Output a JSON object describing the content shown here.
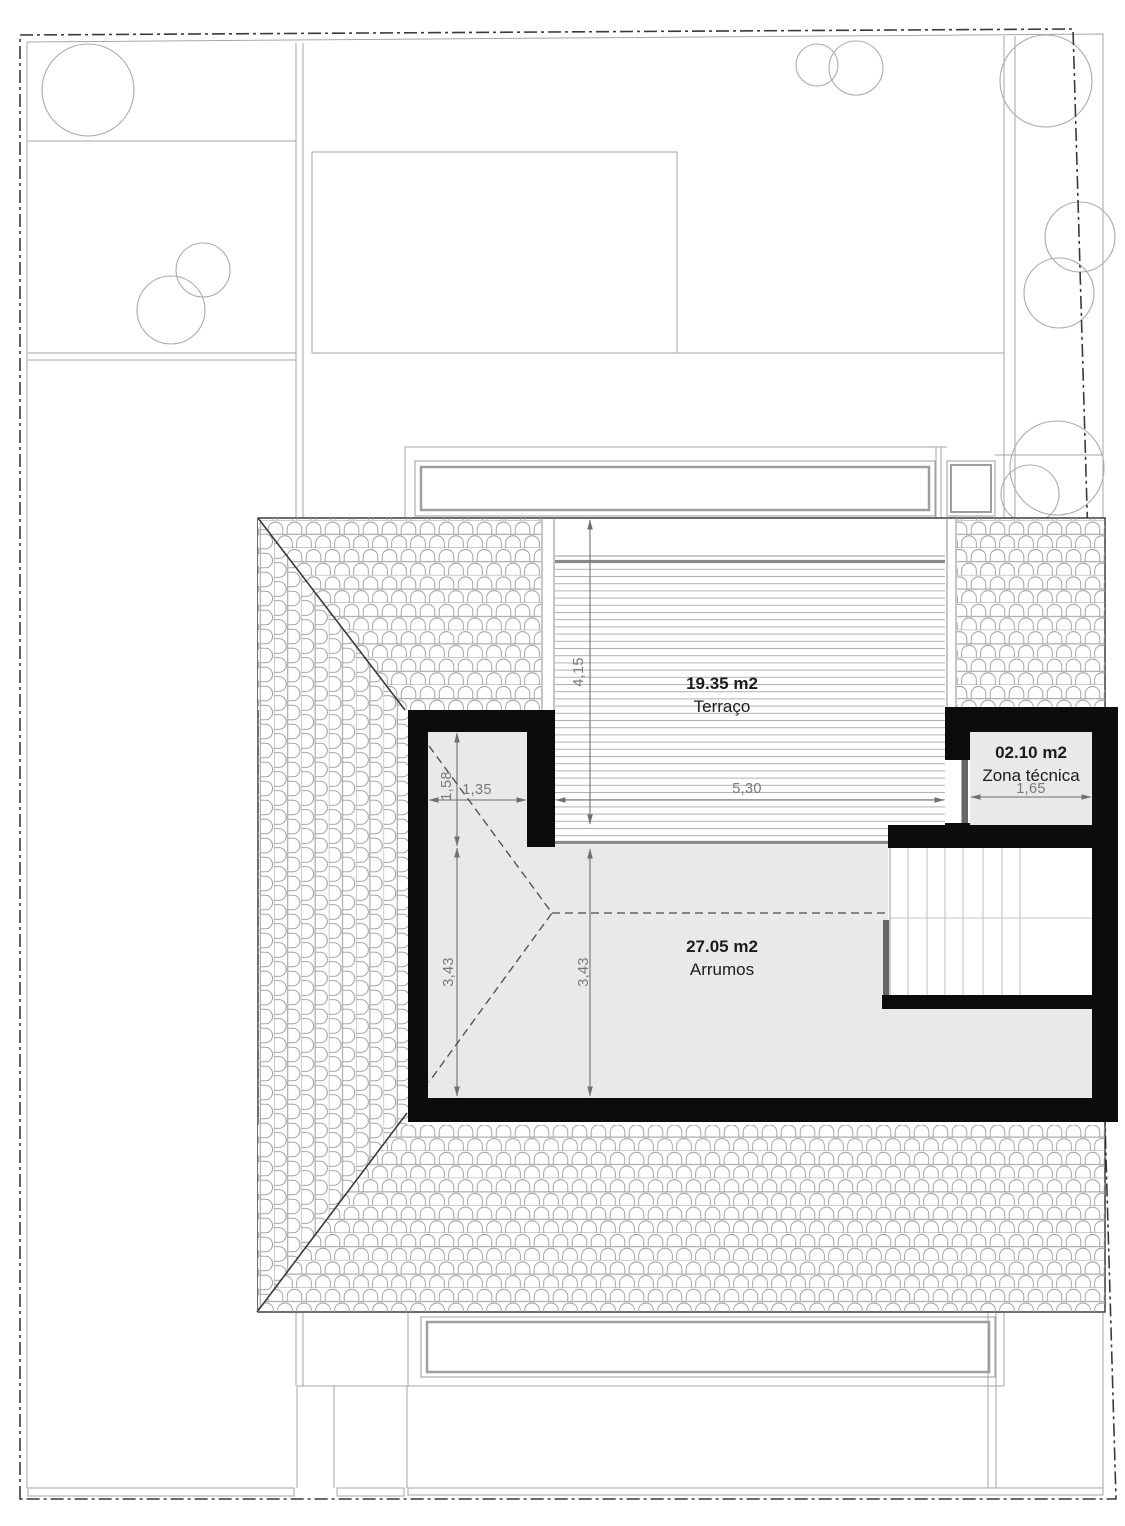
{
  "plan": {
    "rooms": [
      {
        "area": "19.35 m2",
        "name": "Terraço"
      },
      {
        "area": "02.10 m2",
        "name": "Zona técnica"
      },
      {
        "area": "27.05 m2",
        "name": "Arrumos"
      }
    ],
    "dims": {
      "terrace_height": "4,15",
      "terrace_width": "5,30",
      "nook_width": "1,35",
      "nook_height": "1,58",
      "storage_left_height": "3,43",
      "storage_mid_height": "3,43",
      "technical_width": "1,65"
    },
    "colors": {
      "wall": "#0c0c0c",
      "room_fill": "#e9e9e9",
      "tile_line": "#9b9b9b",
      "garden_line": "#a6a6a6",
      "dim_line": "#6f6f6f",
      "label_text": "#1c1c1c"
    }
  }
}
